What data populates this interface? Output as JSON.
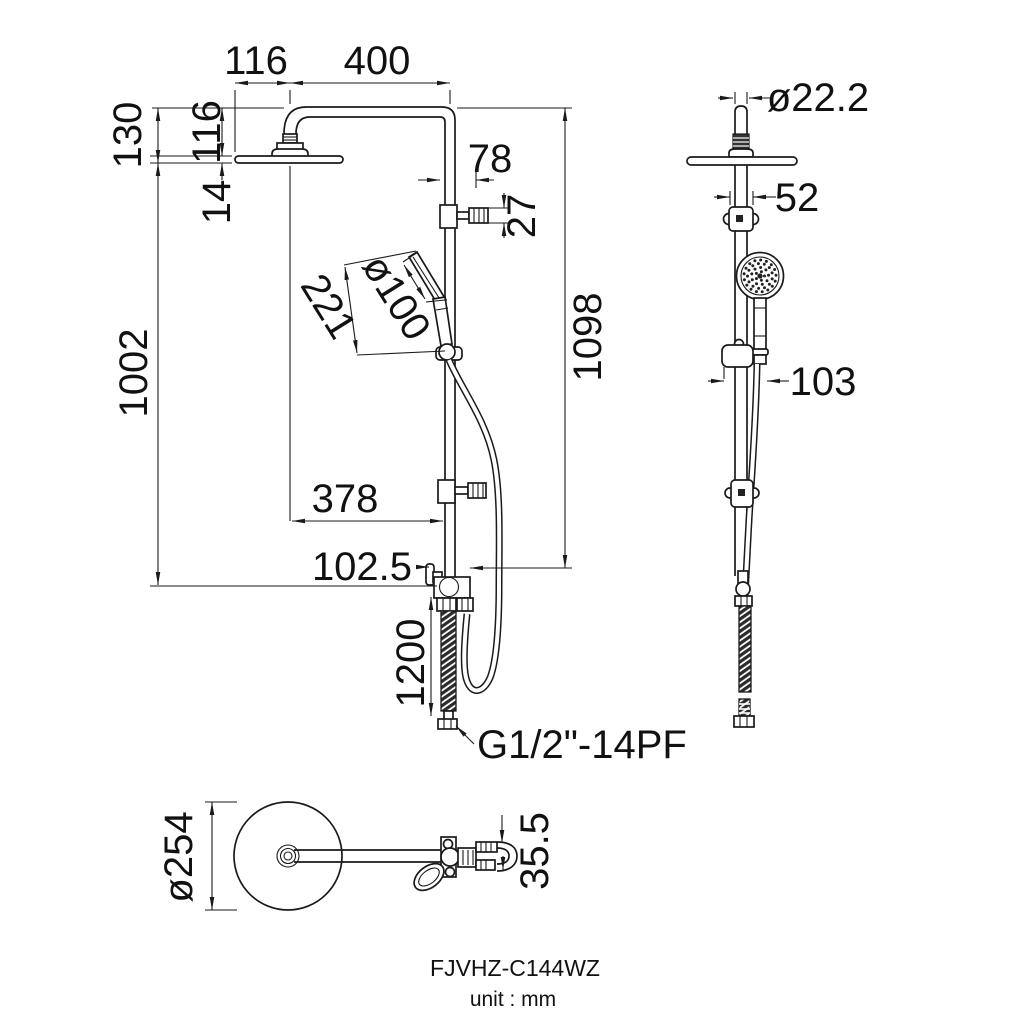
{
  "drawing": {
    "title_block": {
      "model": "FJVHZ-C144WZ",
      "unit": "unit : mm"
    },
    "colors": {
      "line": "#1a1a1a",
      "background": "#ffffff"
    },
    "front_view": {
      "dims": {
        "head_offset": "116",
        "arm_reach": "400",
        "top_to_head_bottom": "130",
        "top_to_head_top": "116",
        "head_thickness": "14",
        "diverter_offset": "78",
        "diverter_knob_height": "27",
        "handshower_length": "221",
        "handshower_diameter": "ø100",
        "column_length": "1098",
        "head_to_valve": "1002",
        "head_center_to_column": "378",
        "valve_offset": "102.5",
        "hose_length": "1200",
        "inlet_thread": "G1/2\"-14PF"
      }
    },
    "side_view": {
      "dims": {
        "pipe_diameter": "ø22.2",
        "bracket_width": "52",
        "wall_clearance": "103"
      }
    },
    "top_view": {
      "dims": {
        "head_diameter": "ø254",
        "outlet_spacing": "35.5"
      }
    }
  }
}
